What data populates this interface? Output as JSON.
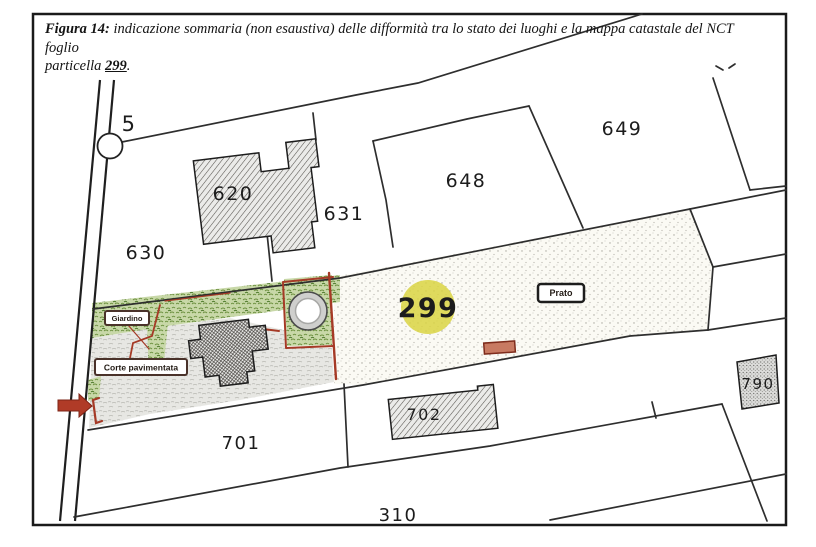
{
  "caption": {
    "prefix": "Figura 14:",
    "line1": " indicazione sommaria (non esaustiva) delle difformità tra lo stato dei luoghi e la mappa catastale del NCT foglio",
    "line2_start": "particella ",
    "parcel_ref": "299",
    "end": "."
  },
  "map": {
    "parcels": {
      "p5": "5",
      "p620": "620",
      "p630": "630",
      "p631": "631",
      "p648": "648",
      "p649": "649",
      "p701": "701",
      "p702": "702",
      "p790": "790",
      "p310": "310"
    },
    "highlight": {
      "label": "299"
    },
    "area_labels": {
      "giardino": "Giardino",
      "corte": "Corte pavimentata",
      "prato": "Prato"
    }
  },
  "colors": {
    "accent-red": "#a53a26",
    "arrow-red": "#b03b27",
    "highlight-yellow": "#d9d442",
    "garden-green": "#8fae5e",
    "map-line": "#2e2e2e"
  }
}
